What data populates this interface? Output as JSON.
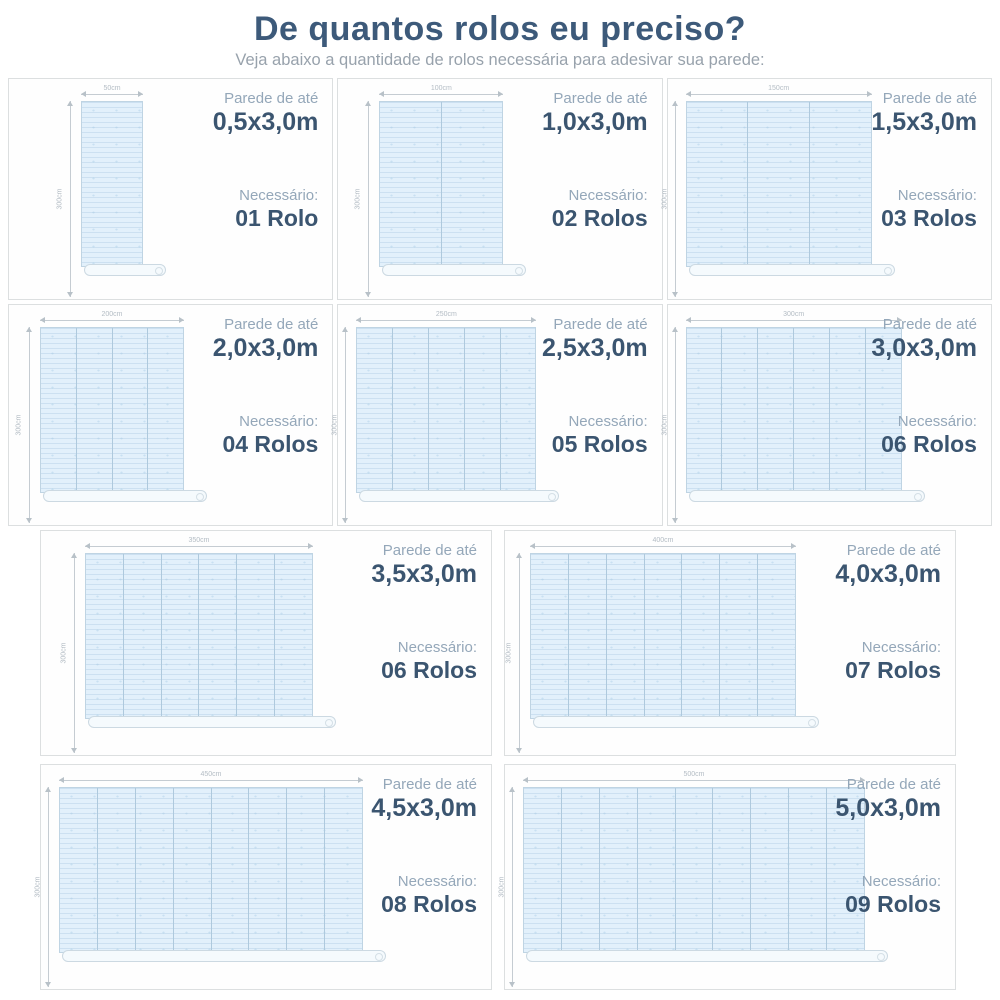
{
  "title": "De quantos rolos eu preciso?",
  "subtitle": "Veja abaixo a quantidade de rolos necessária para adesivar sua parede:",
  "labels": {
    "wall_prefix": "Parede de até",
    "needed_prefix": "Necessário:",
    "height_dim": "300cm"
  },
  "colors": {
    "title": "#3d5a7a",
    "subtitle": "#98a2ac",
    "label": "#94a7b9",
    "value": "#3b5570",
    "wall_fill": "#e2f0fb",
    "wall_border": "#bfd4e3",
    "panel_border": "#dcdfe0"
  },
  "panels": [
    {
      "size": "0,5x3,0m",
      "rolls": "01 Rolo",
      "strips": 1,
      "width_dim": "50cm"
    },
    {
      "size": "1,0x3,0m",
      "rolls": "02 Rolos",
      "strips": 2,
      "width_dim": "100cm"
    },
    {
      "size": "1,5x3,0m",
      "rolls": "03 Rolos",
      "strips": 3,
      "width_dim": "150cm"
    },
    {
      "size": "2,0x3,0m",
      "rolls": "04 Rolos",
      "strips": 4,
      "width_dim": "200cm"
    },
    {
      "size": "2,5x3,0m",
      "rolls": "05 Rolos",
      "strips": 5,
      "width_dim": "250cm"
    },
    {
      "size": "3,0x3,0m",
      "rolls": "06 Rolos",
      "strips": 6,
      "width_dim": "300cm"
    },
    {
      "size": "3,5x3,0m",
      "rolls": "06 Rolos",
      "strips": 6,
      "width_dim": "350cm"
    },
    {
      "size": "4,0x3,0m",
      "rolls": "07 Rolos",
      "strips": 7,
      "width_dim": "400cm"
    },
    {
      "size": "4,5x3,0m",
      "rolls": "08 Rolos",
      "strips": 8,
      "width_dim": "450cm"
    },
    {
      "size": "5,0x3,0m",
      "rolls": "09 Rolos",
      "strips": 9,
      "width_dim": "500cm"
    }
  ],
  "rows": [
    [
      0,
      1,
      2
    ],
    [
      3,
      4,
      5
    ],
    [
      6,
      7
    ],
    [
      8,
      9
    ]
  ]
}
